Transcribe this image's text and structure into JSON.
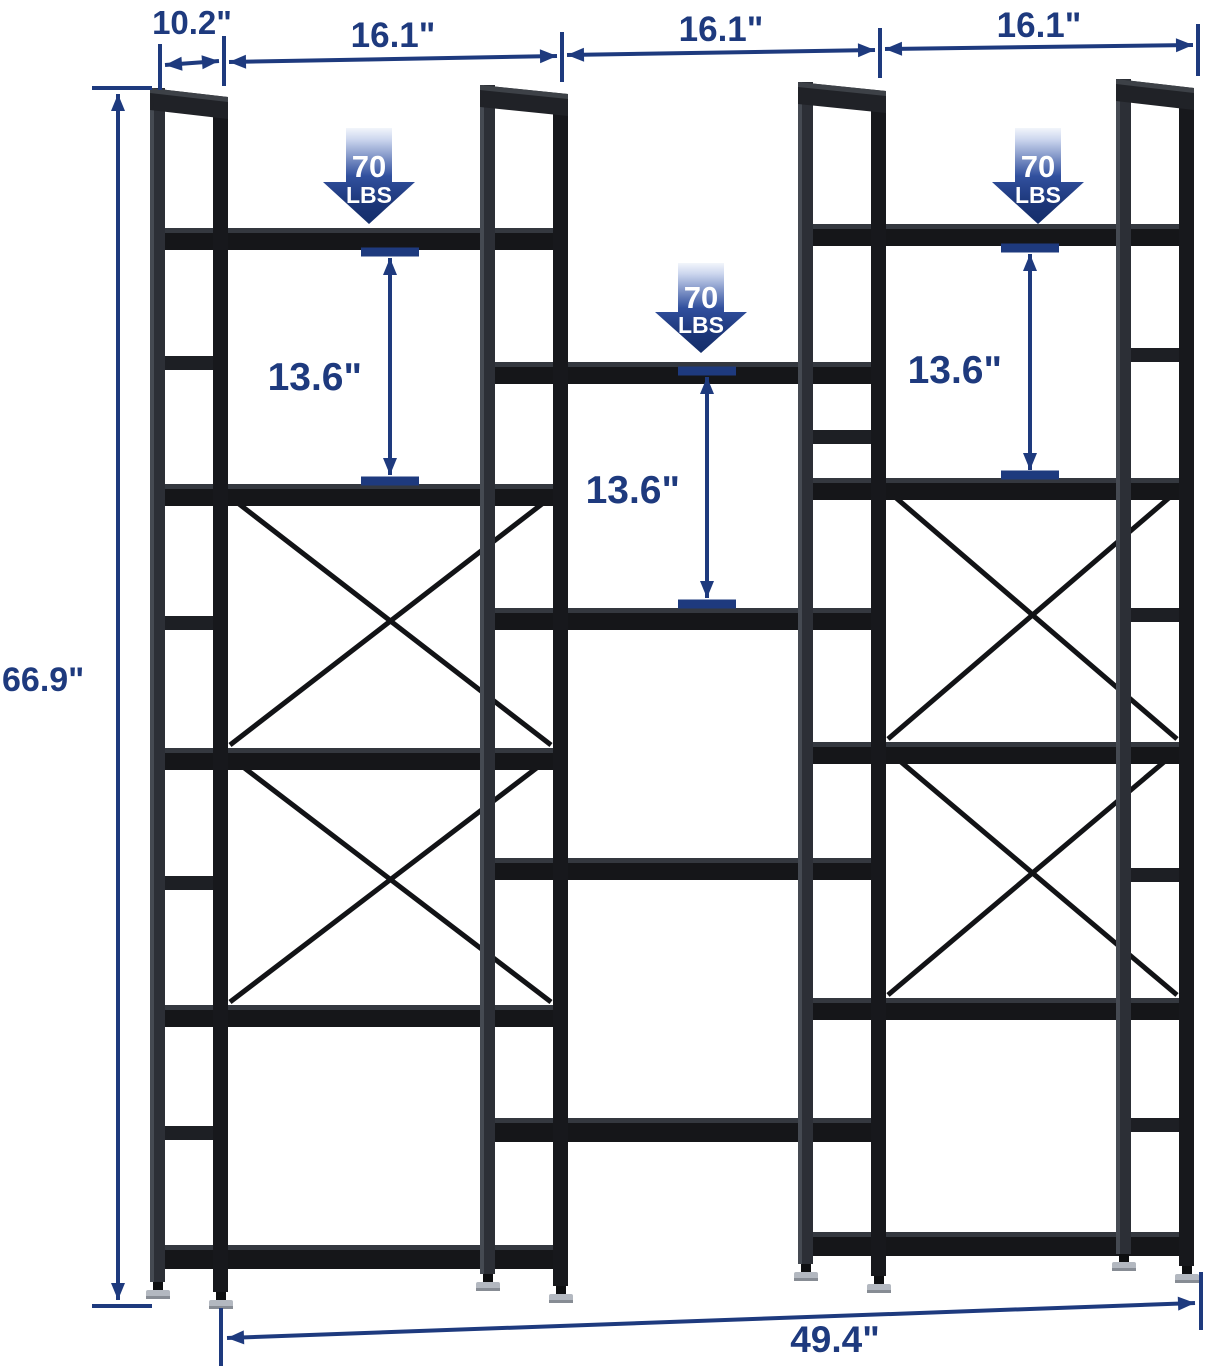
{
  "diagram_title": "triple-wide-bookshelf-dimensions",
  "colors": {
    "dimension_navy": "#1e3a7e",
    "load_arrow_gradient_top": "#f2f5fb",
    "load_arrow_gradient_bottom": "#142e6a",
    "product_black": "#17181c",
    "foot_chrome": "#b3b8c0",
    "background": "#ffffff"
  },
  "annotations": {
    "depth": "10.2\"",
    "bay_widths": [
      "16.1\"",
      "16.1\"",
      "16.1\""
    ],
    "height": "66.9\"",
    "overall_width": "49.4\"",
    "shelf_gaps": [
      "13.6\"",
      "13.6\"",
      "13.6\""
    ],
    "load_badges": [
      {
        "value": "70",
        "unit": "LBS"
      },
      {
        "value": "70",
        "unit": "LBS"
      },
      {
        "value": "70",
        "unit": "LBS"
      }
    ]
  }
}
